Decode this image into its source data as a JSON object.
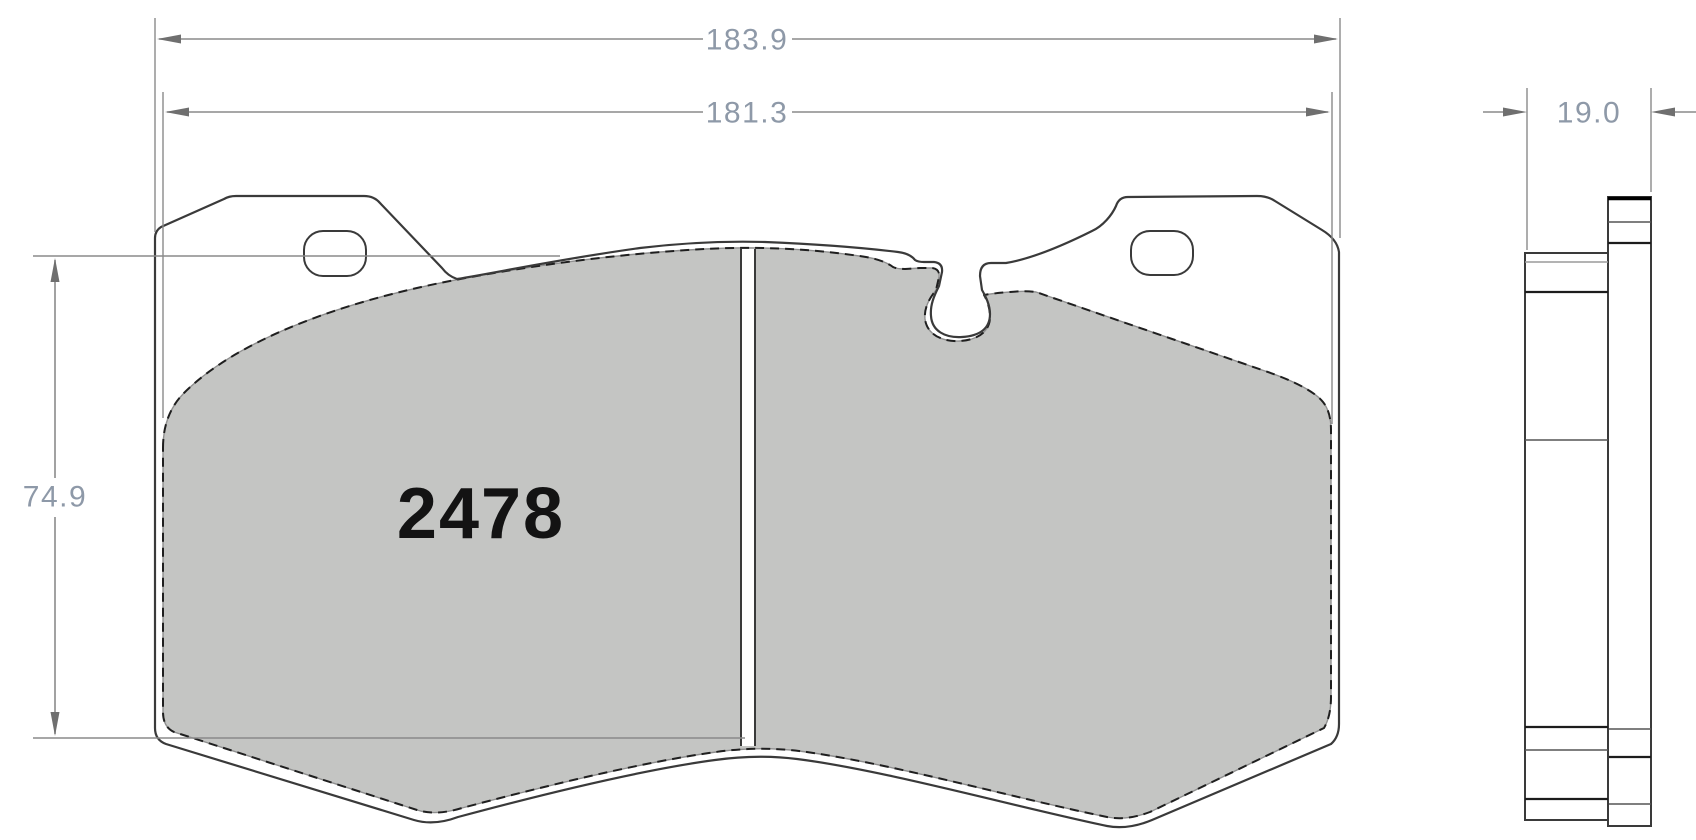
{
  "drawing": {
    "part_number": "2478",
    "dimensions": {
      "overall_width_mm": "183.9",
      "pad_width_mm": "181.3",
      "pad_height_mm": "74.9",
      "thickness_mm": "19.0"
    },
    "colors": {
      "background": "#ffffff",
      "friction_fill": "#c4c5c3",
      "outline": "#3a3a3a",
      "dimension_line": "#8a8a8a",
      "dimension_text": "#8e99a8",
      "part_number_color": "#131313"
    }
  }
}
